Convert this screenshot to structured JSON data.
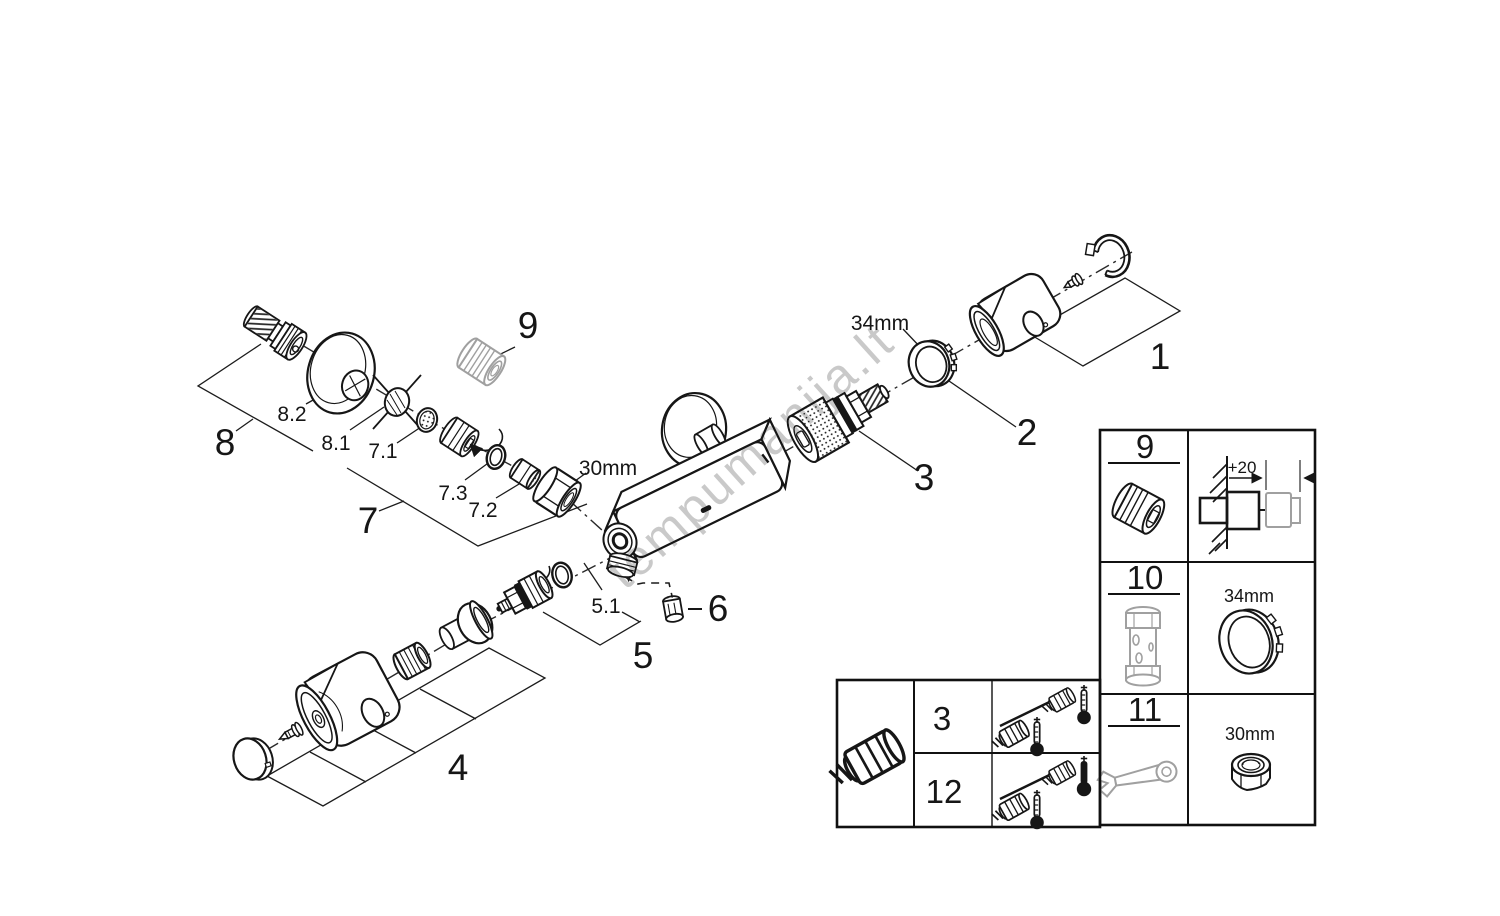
{
  "watermark": "tempumanija.lt",
  "labels": {
    "n1": "1",
    "n2": "2",
    "n3": "3",
    "n4": "4",
    "n5": "5",
    "n5_1": "5.1",
    "n6": "6",
    "n7": "7",
    "n7_1": "7.1",
    "n7_2": "7.2",
    "n7_3": "7.3",
    "n8": "8",
    "n8_1": "8.1",
    "n8_2": "8.2",
    "n9": "9"
  },
  "dims": {
    "d30": "30mm",
    "d34": "34mm"
  },
  "accessories_table": {
    "rows": [
      {
        "num": "9",
        "icon": "extension-adapter-icon",
        "detail": "+20"
      },
      {
        "num": "10",
        "icon": "mounting-sleeve-icon",
        "detail": "34mm"
      },
      {
        "num": "11",
        "icon": "wrench-icon",
        "detail": "30mm"
      }
    ]
  },
  "cartridge_table": {
    "icon": "thermostatic-cartridge-icon",
    "rows": [
      {
        "num": "3",
        "icon": "temperature-calibration-icon"
      },
      {
        "num": "12",
        "icon": "temperature-calibration-hot-icon"
      }
    ]
  },
  "colors": {
    "line": "#161616",
    "gray": "#a0a0a0",
    "watermark": "#c3c3c3",
    "background": "#ffffff"
  }
}
